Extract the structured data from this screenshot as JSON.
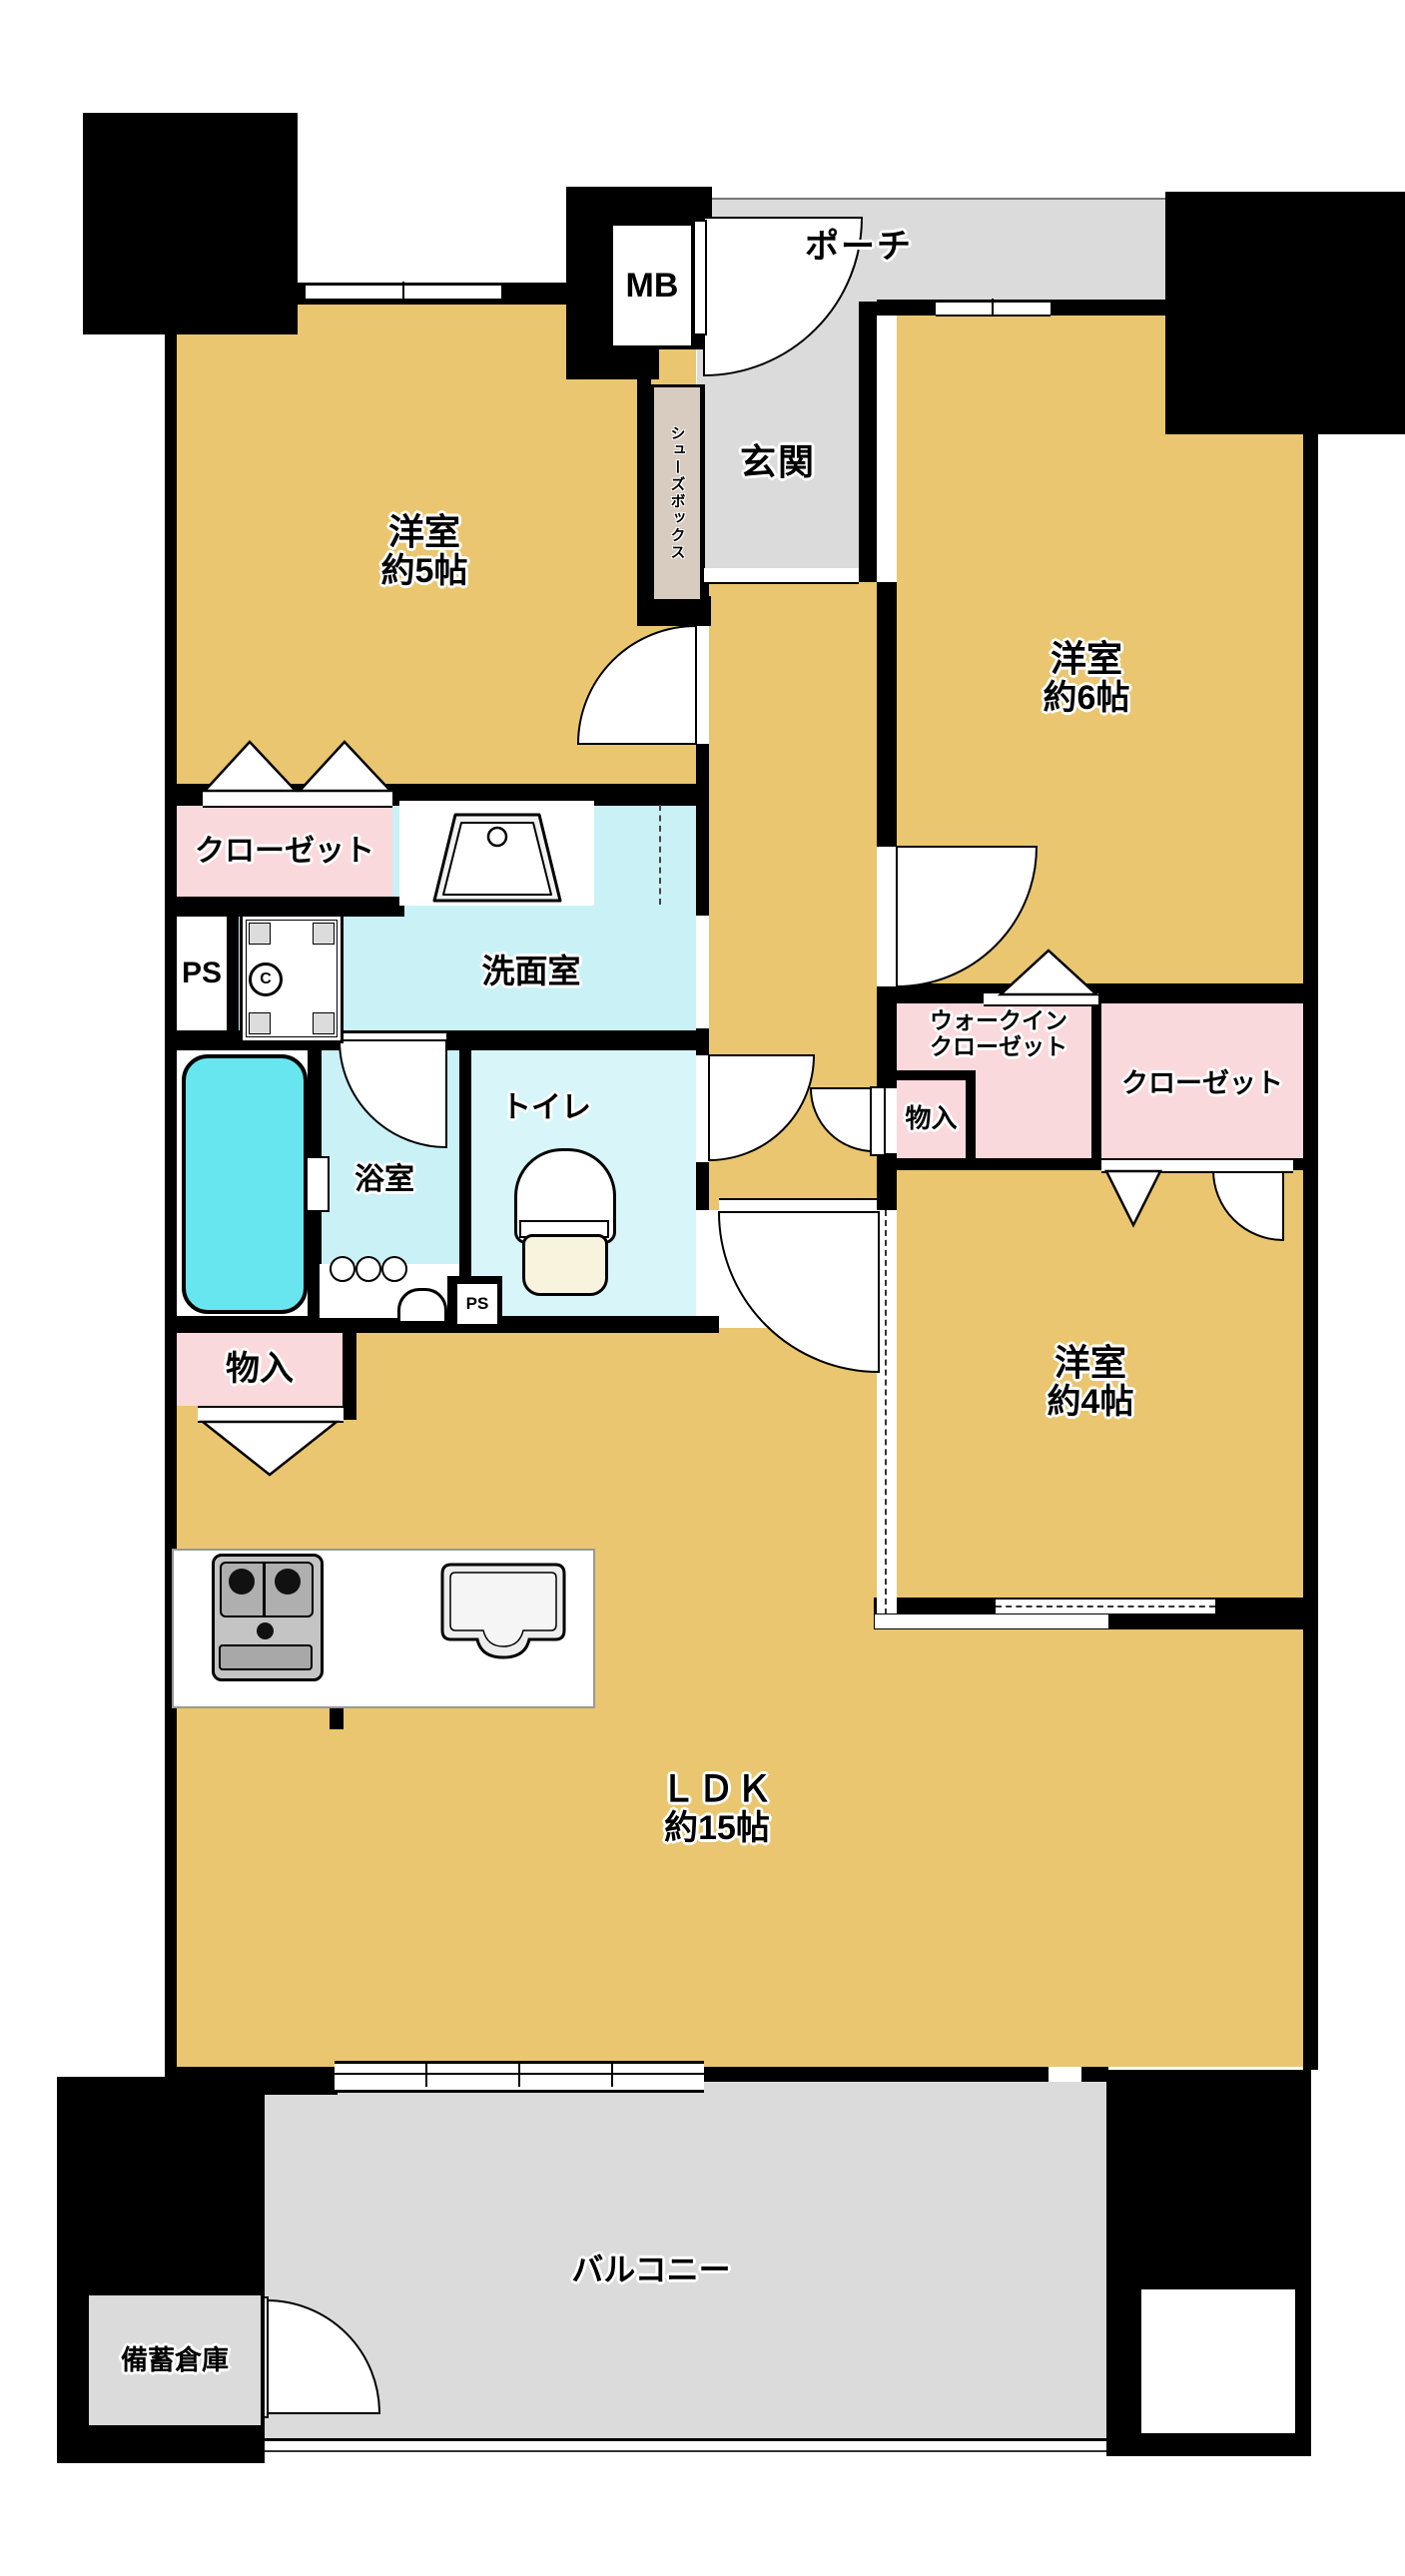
{
  "title": "floor-plan",
  "rooms": {
    "porch": {
      "label": "ポーチ"
    },
    "mb": {
      "label": "MB"
    },
    "genkan": {
      "label": "玄関"
    },
    "shoebox": {
      "label": "シューズボックス"
    },
    "west5": {
      "name": "洋室",
      "size": "約5帖"
    },
    "west6": {
      "name": "洋室",
      "size": "約6帖"
    },
    "west4": {
      "name": "洋室",
      "size": "約4帖"
    },
    "ldk": {
      "name": "ＬＤＫ",
      "size": "約15帖"
    },
    "washroom": {
      "label": "洗面室"
    },
    "bath": {
      "label": "浴室"
    },
    "toilet": {
      "label": "トイレ"
    },
    "closet_left": {
      "label": "クローゼット"
    },
    "closet_right": {
      "label": "クローゼット"
    },
    "wic": {
      "line1": "ウォークイン",
      "line2": "クローゼット"
    },
    "storage_left": {
      "label": "物入"
    },
    "storage_hall": {
      "label": "物入"
    },
    "ps": {
      "label": "PS"
    },
    "ps_small": {
      "label": "PS"
    },
    "balcony": {
      "label": "バルコニー"
    },
    "reserve": {
      "label": "備蓄倉庫"
    }
  },
  "fixtures": {
    "washer_drain": "C"
  },
  "colors": {
    "floor": "#E9C66F",
    "outdoor": "#DBDBDB",
    "water": "#C9F1F6",
    "waterLight": "#D8F6FA",
    "pink": "#FAD9DC",
    "shoebox": "#D8CBBF",
    "tub": "#68E6EF",
    "seat": "#F8F3DC",
    "wall": "#000000"
  }
}
